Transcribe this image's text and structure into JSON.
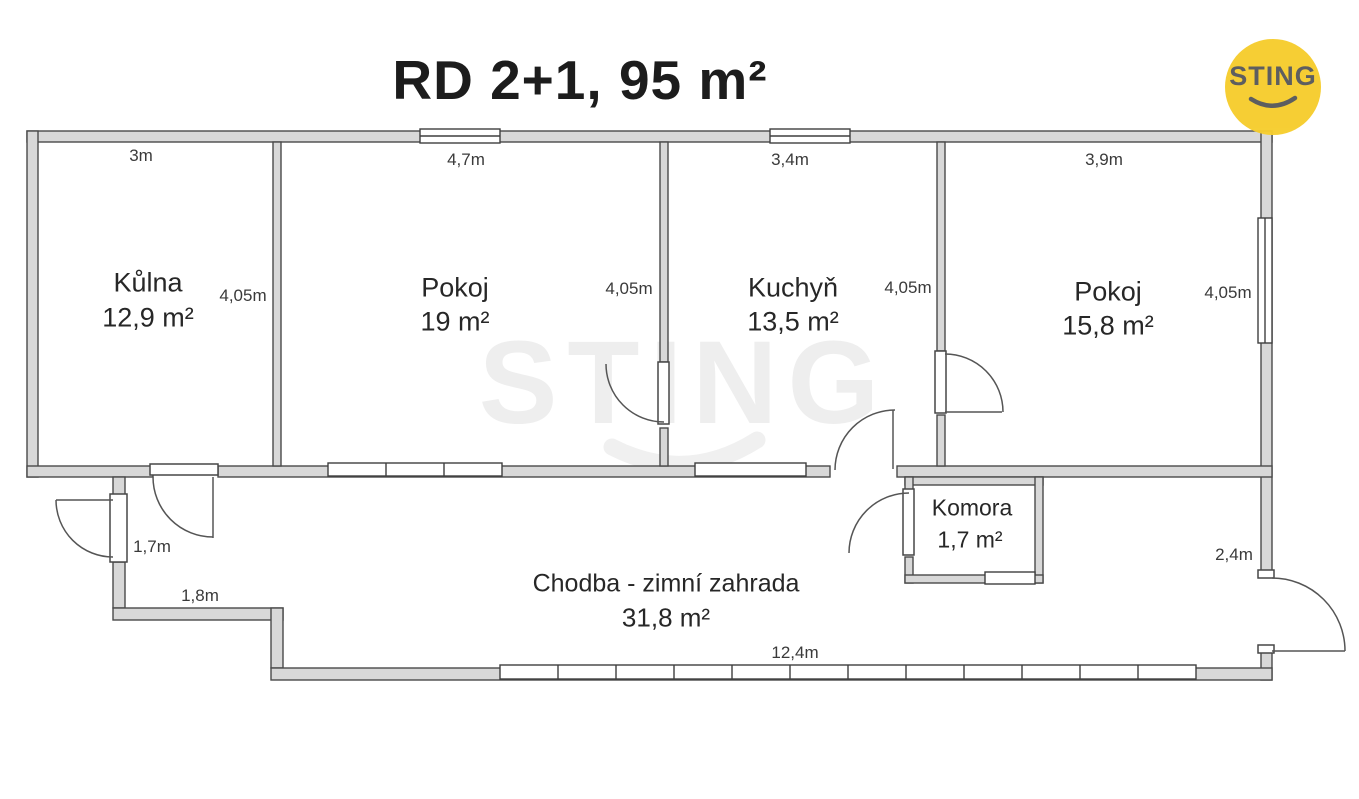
{
  "title": "RD 2+1, 95 m²",
  "logo": {
    "text": "STING"
  },
  "watermark": {
    "text": "STING"
  },
  "rooms": [
    {
      "name": "Kůlna",
      "area": "12,9 m²",
      "width": "3m",
      "depth": "4,05m"
    },
    {
      "name": "Pokoj",
      "area": "19 m²",
      "width": "4,7m",
      "depth": "4,05m"
    },
    {
      "name": "Kuchyň",
      "area": "13,5 m²",
      "width": "3,4m",
      "depth": "4,05m"
    },
    {
      "name": "Pokoj",
      "area": "15,8 m²",
      "width": "3,9m",
      "depth": "4,05m"
    },
    {
      "name": "Komora",
      "area": "1,7 m²"
    },
    {
      "name": "Chodba - zimní zahrada",
      "area": "31,8 m²",
      "width": "12,4m"
    }
  ],
  "dims": {
    "hall_door_width": "1,7m",
    "hall_step": "1,8m",
    "hall_right": "2,4m"
  },
  "colors": {
    "wall_fill": "#d8d8d8",
    "wall_stroke": "#4a4a4a",
    "logo_bg": "#f6cd2e",
    "logo_fg": "#58595b"
  }
}
